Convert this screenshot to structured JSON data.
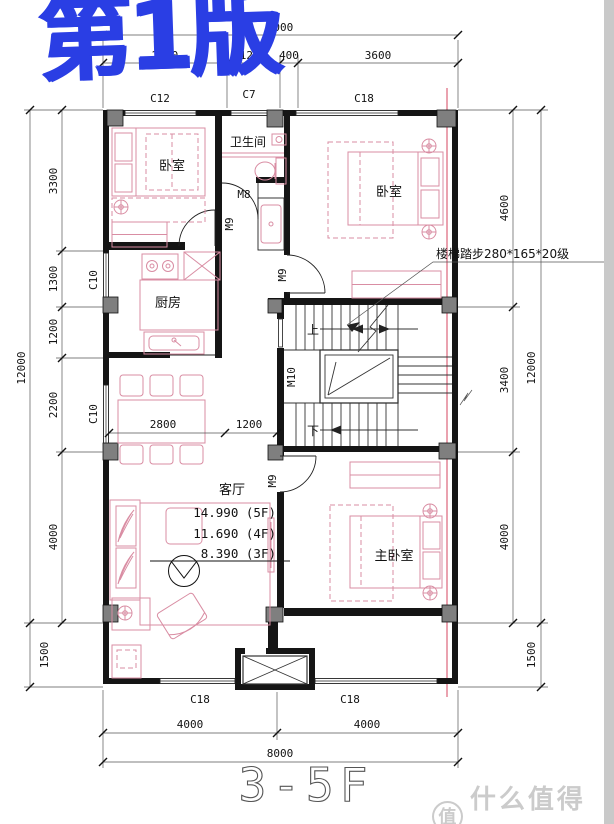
{
  "edition_watermark": "第1版",
  "plan_title": "3-5F",
  "brand_watermark": {
    "badge": "值",
    "name": "什么值得买"
  },
  "annotations": {
    "stairs_note": "楼梯踏步280*165*20级",
    "up": "上",
    "down": "下"
  },
  "rooms": {
    "bedroom_top_left": "卧室",
    "bathroom": "卫生间",
    "bedroom_top_right": "卧室",
    "kitchen": "厨房",
    "living_room": "客厅",
    "master_bedroom": "主卧室"
  },
  "elevations": {
    "l1": "14.990 (5F)",
    "l2": "11.690 (4F)",
    "l3": "8.390 (3F)"
  },
  "doors": {
    "m8": "M8",
    "m9": "M9",
    "m10": "M10"
  },
  "windows": {
    "c12": "C12",
    "c7": "C7",
    "c18": "C18",
    "c10": "C10"
  },
  "dims": {
    "top_total": "8000",
    "top_1": "2800",
    "top_2": "1200",
    "top_3": "400",
    "top_4": "3600",
    "left_1": "3300",
    "left_2": "1300",
    "left_3": "1200",
    "left_4": "2200",
    "left_5": "4000",
    "left_6": "1500",
    "left_total": "12000",
    "right_1": "4600",
    "right_2": "3400",
    "right_3": "4000",
    "right_4": "1500",
    "right_total": "12000",
    "bottom_1": "4000",
    "bottom_2": "4000",
    "bottom_total": "8000",
    "interior_1": "2800",
    "interior_2": "1200"
  },
  "colors": {
    "wall": "#151515",
    "column_grey": "#7f7f7f",
    "furniture_pink": "#d98da3",
    "axis_red": "#e0758a",
    "graffiti_blue": "#2a3ee4",
    "brand_grey": "#cbcbcb",
    "dim_text": "#111111"
  }
}
